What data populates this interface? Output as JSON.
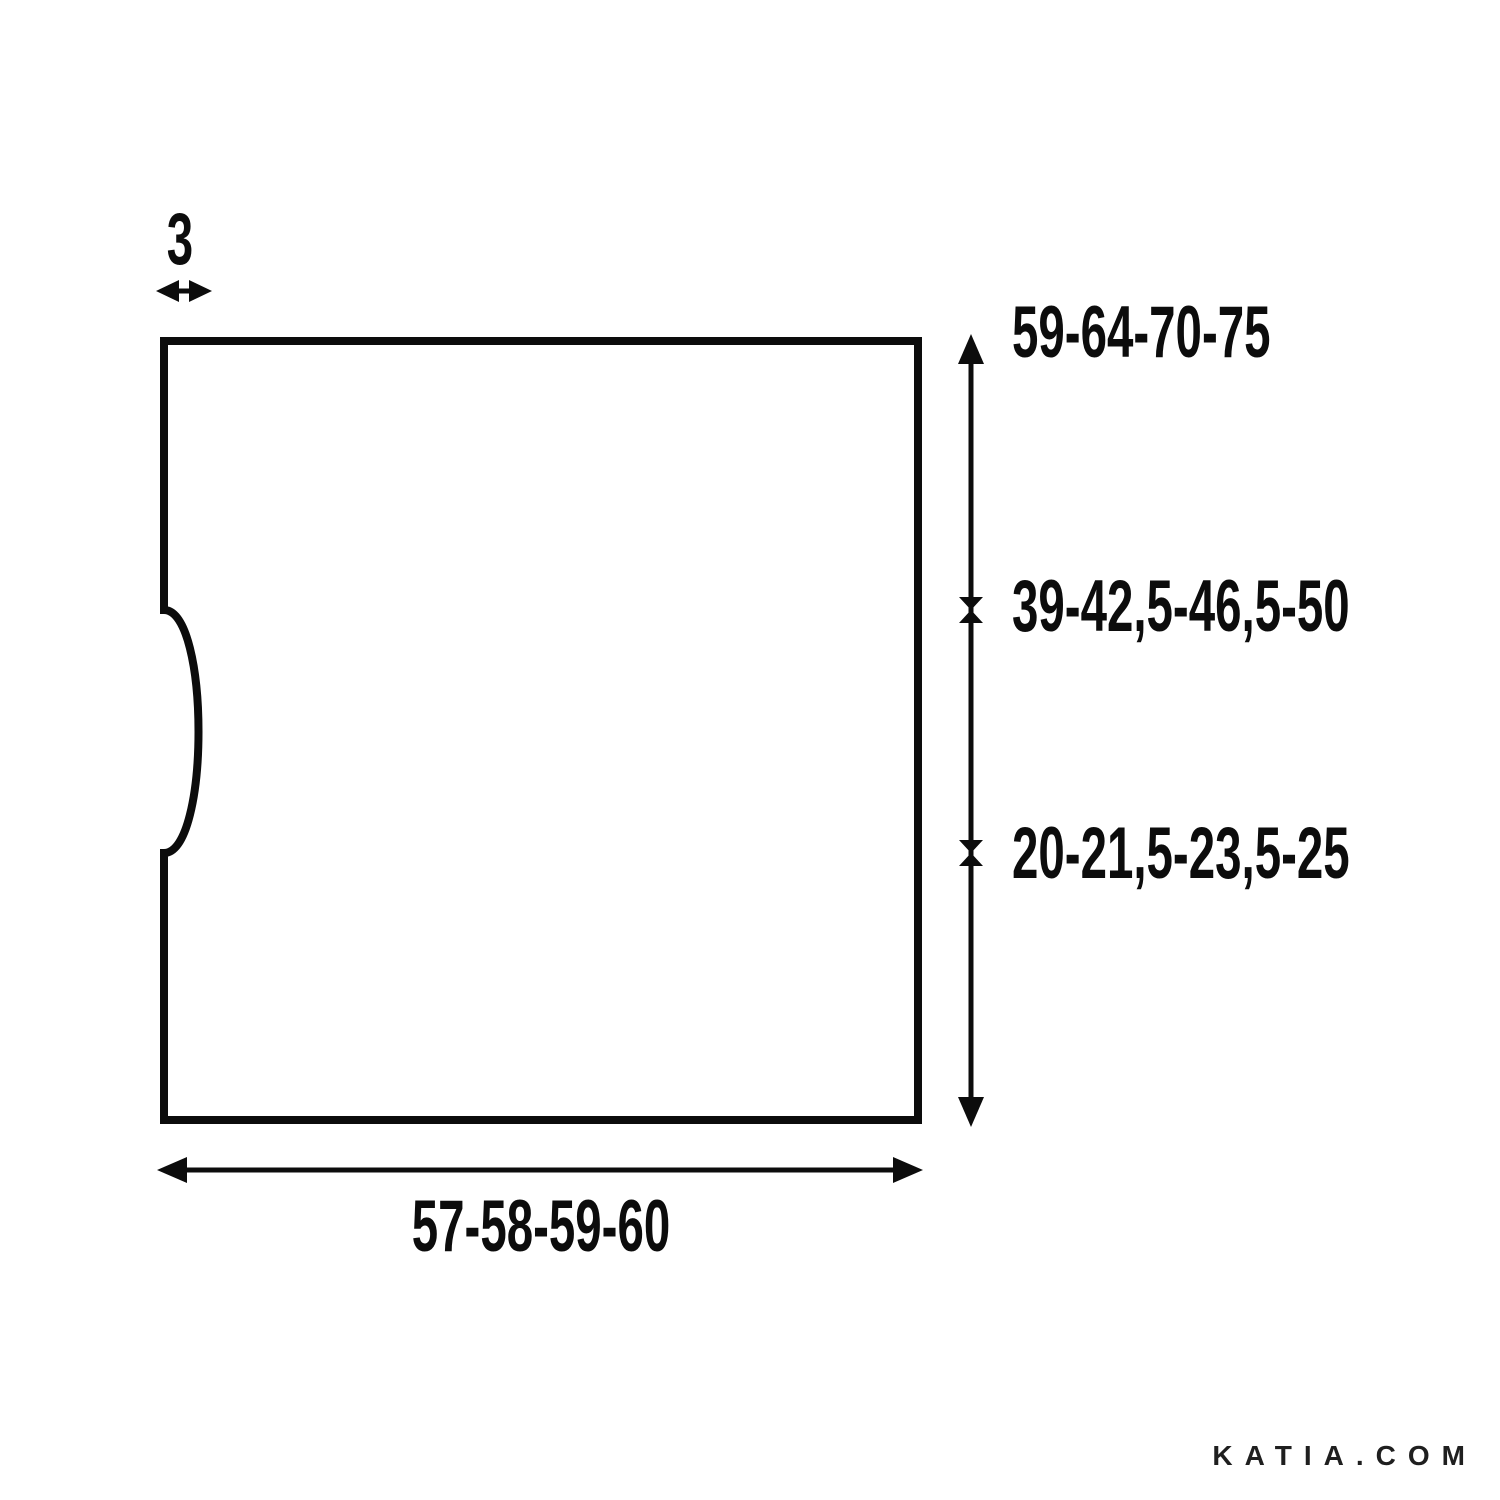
{
  "schematic": {
    "labels": {
      "neck_depth": "3",
      "total_height": "59-64-70-75",
      "upper_height": "39-42,5-46,5-50",
      "lower_height": "20-21,5-23,5-25",
      "width": "57-58-59-60"
    },
    "icons": {
      "neck_width_arrow": "double-arrow-horizontal",
      "height_measure_arrow": "double-arrow-vertical-with-ticks",
      "width_measure_arrow": "double-arrow-horizontal"
    }
  },
  "watermark": {
    "text": "KATIA.COM"
  },
  "colors": {
    "line": "#0c0c0c",
    "text": "#0c0c0c",
    "watermark": "#1f1f1f",
    "background": "#ffffff"
  }
}
